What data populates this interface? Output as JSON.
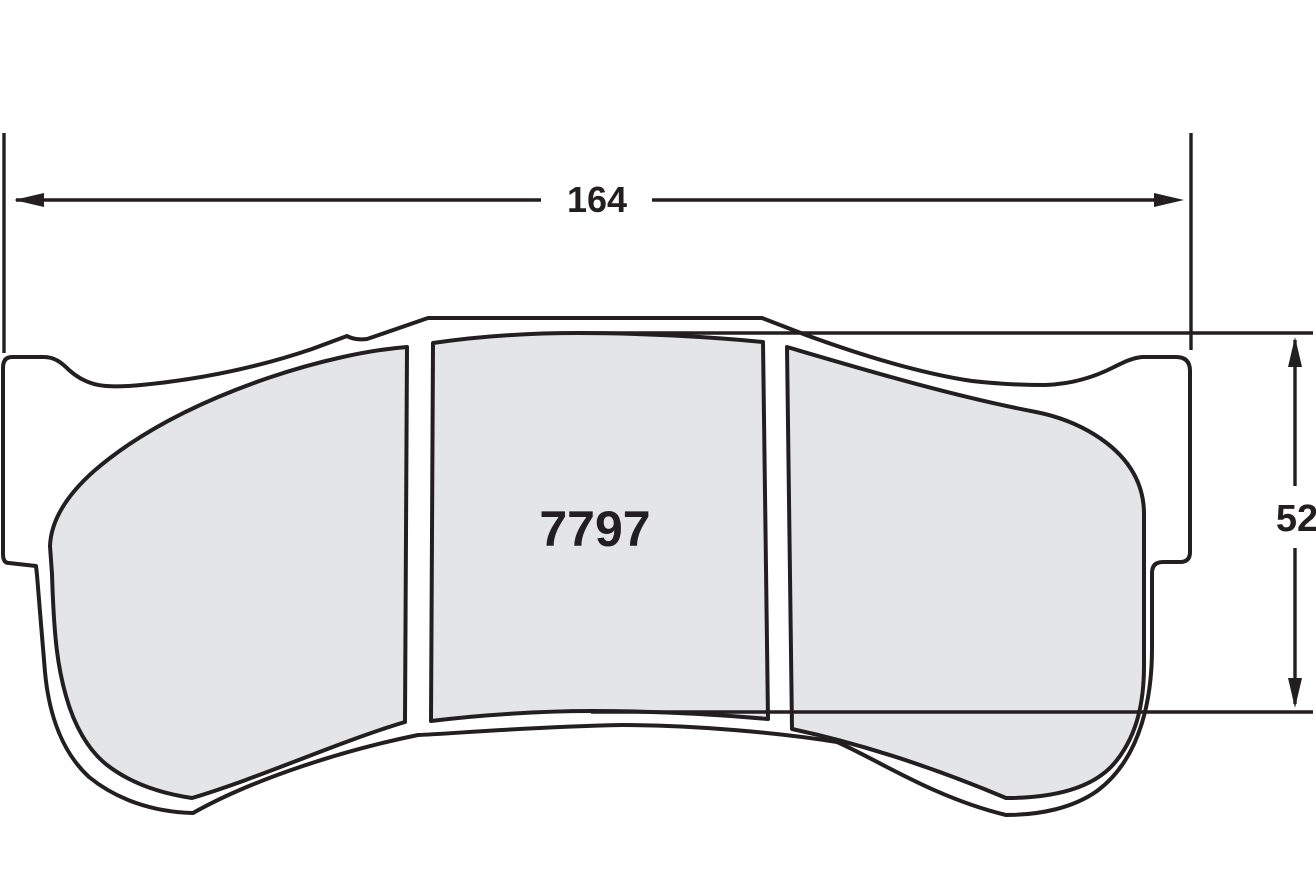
{
  "drawing": {
    "title": "brake-pad-dimension-drawing",
    "part_number": "7797",
    "dimensions": {
      "width": {
        "label": "164"
      },
      "height": {
        "label": "52"
      }
    },
    "colors": {
      "line": "#231f20",
      "friction_fill": "#e4e5e7",
      "background": "#ffffff"
    }
  }
}
